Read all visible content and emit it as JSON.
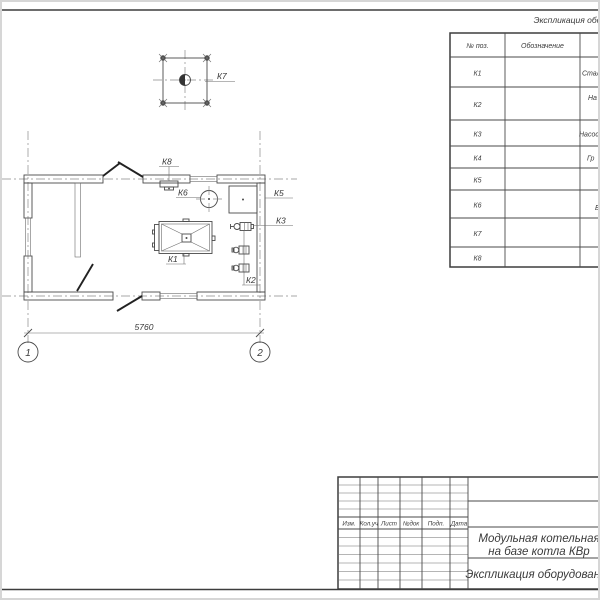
{
  "colors": {
    "ink": "#3d3d3d",
    "thin_line": "#6d6d6d",
    "centerline": "#8a8a8a",
    "paper": "#ffffff"
  },
  "drawing": {
    "plan_labels": {
      "k1": "К1",
      "k2": "К2",
      "k3": "К3",
      "k5": "К5",
      "k6": "К6",
      "k7": "К7",
      "k8": "К8"
    },
    "dimension_value": "5760",
    "axes": [
      "1",
      "2"
    ]
  },
  "equipment_table": {
    "title": "Экспликация оборудования",
    "headers": {
      "pos": "№ поз.",
      "designation": "Обозначение"
    },
    "rows": [
      {
        "pos": "К1",
        "designation": "",
        "name": "Стал"
      },
      {
        "pos": "К2",
        "designation": "",
        "name": "На"
      },
      {
        "pos": "К3",
        "designation": "",
        "name": "Насос"
      },
      {
        "pos": "К4",
        "designation": "",
        "name": "Гр"
      },
      {
        "pos": "К5",
        "designation": "",
        "name": ""
      },
      {
        "pos": "К6",
        "designation": "",
        "name": "Б"
      },
      {
        "pos": "К7",
        "designation": "",
        "name": ""
      },
      {
        "pos": "К8",
        "designation": "",
        "name": ""
      }
    ]
  },
  "title_block": {
    "revision_headers": [
      "Изм.",
      "Кол.уч",
      "Лист",
      "№док",
      "Подп.",
      "Дата"
    ],
    "project_title_line1": "Модульная котельная",
    "project_title_line2": "на базе котла КВр",
    "doc_title": "Экспликация оборудования"
  }
}
